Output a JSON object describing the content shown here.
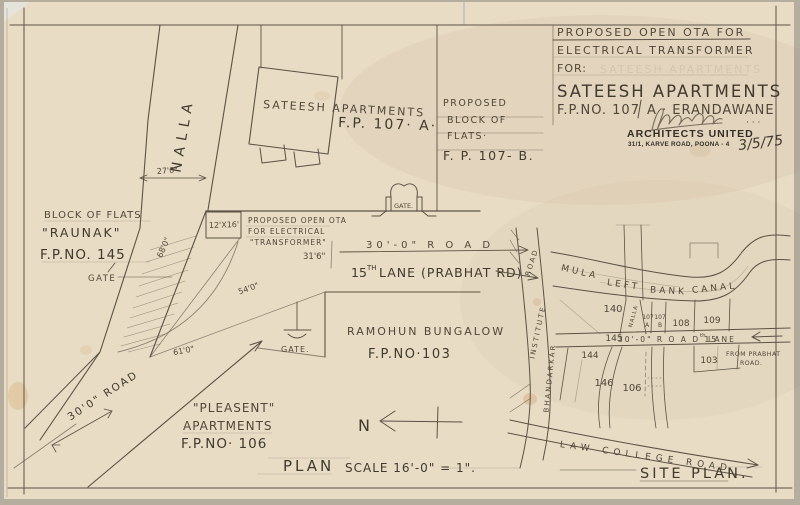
{
  "title_block": {
    "line1": "PROPOSED OPEN OTA FOR",
    "line2": "ELECTRICAL TRANSFORMER",
    "line3": "FOR:",
    "client": "SATEESH APARTMENTS",
    "plot_no": "F.P.NO. 107",
    "locality": "A · ERANDAWANE",
    "firm": "ARCHITECTS UNITED",
    "firm_address": "31/1, KARVE ROAD, POONA - 4",
    "date": "3/5/75",
    "sig_dots": "· · ·"
  },
  "plan": {
    "nalla_label": "NALLA",
    "building_name": "SATEESH APARTMENTS",
    "building_plot": "F.P. 107· A·",
    "proposed_block": [
      "PROPOSED",
      "BLOCK OF",
      "FLATS·",
      "F. P. 107- B."
    ],
    "raunak": [
      "BLOCK OF FLATS",
      "\"RAUNAK\"",
      "F.P.NO. 145"
    ],
    "gate_left": "GATE",
    "gate_top": "GATE.",
    "gate_mid": "GATE.",
    "ota_size": "12'X16'",
    "ota_note": [
      "PROPOSED OPEN OTA",
      "FOR ELECTRICAL",
      "\"TRANSFORMER\""
    ],
    "dim_27": "27'0\"",
    "dim_68": "68'0\"",
    "dim_54": "54'0\"",
    "dim_61": "61'0\"",
    "dim_316": "31'6\"",
    "road_30_top": "30'-0\"  R O A D",
    "lane15_num": "15",
    "lane15_sup": "TH",
    "lane15_rest": "LANE (PRABHAT RD)",
    "ramohun": [
      "RAMOHUN BUNGALOW",
      "F.P.NO·103"
    ],
    "pleasent": [
      "\"PLEASENT\"",
      "APARTMENTS",
      "F.P.NO· 106"
    ],
    "road_30_left": "30'0\" ROAD",
    "plan_title": "PLAN",
    "plan_scale": "SCALE 16'-0\" = 1\".",
    "north_label": "N"
  },
  "site_plan": {
    "canal": [
      "MULA",
      "LEFT",
      "BANK",
      "CANAL"
    ],
    "bhandarkar_road": [
      "BHANDARKAR",
      "INSTITUTE",
      "ROAD"
    ],
    "nalla_small": "NALLA",
    "plots": {
      "p140": "140",
      "p107a_top": "107",
      "p107a_bot": "A",
      "p107b_top": "107",
      "p107b_bot": "B",
      "p108": "108",
      "p109": "109",
      "p145": "145",
      "p144": "144",
      "p146": "146",
      "p106": "106",
      "p103": "103"
    },
    "road_30": "30'-0\"  R O A D  15",
    "road_30_sup": "th",
    "road_30_rest": "LANE",
    "from_prabhat": [
      "FROM PRABHAT",
      "ROAD."
    ],
    "law_college": "LAW  COLLEGE  ROAD",
    "title": "SITE PLAN."
  }
}
